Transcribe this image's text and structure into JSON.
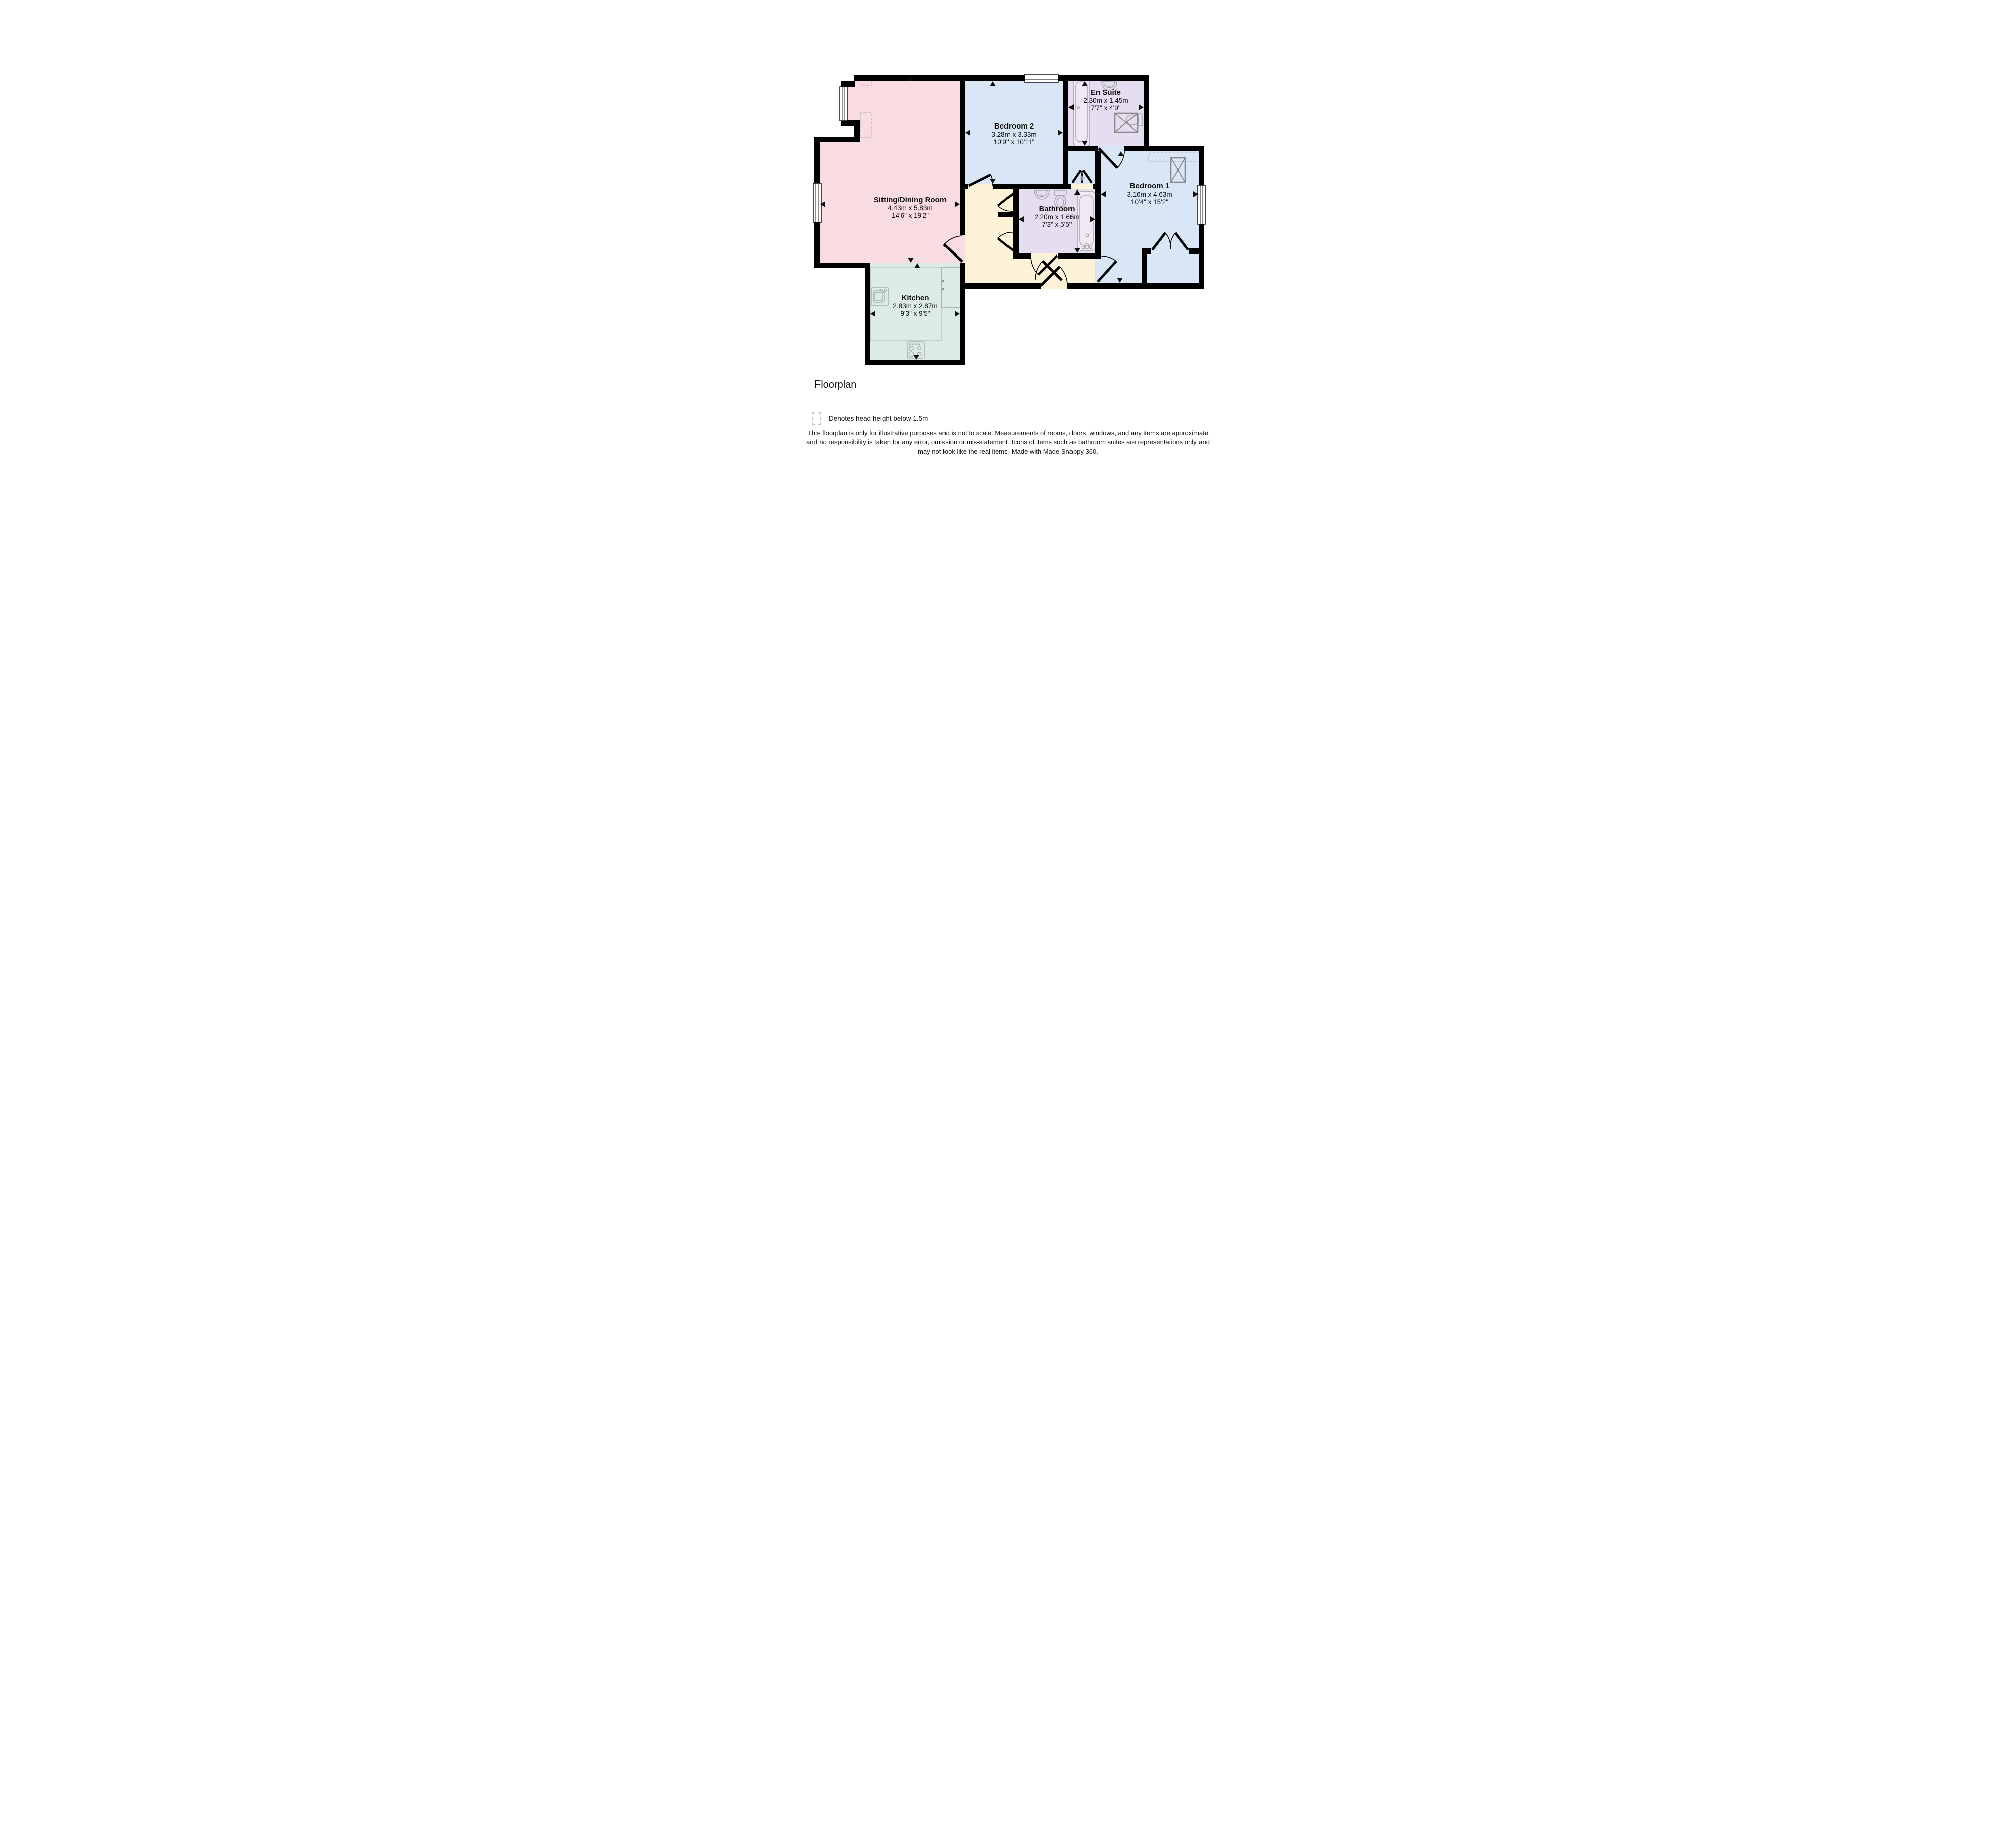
{
  "title": "Floorplan",
  "legend": {
    "icon": "dashed-rect-icon",
    "text": "Denotes head height below 1.5m"
  },
  "disclaimer": {
    "line1": "This floorplan is only for illustrative purposes and is not to scale. Measurements of rooms, doors, windows, and any items are approximate",
    "line2": "and no responsibility is taken for any error, omission or mis-statement. Icons of items such as bathroom suites are representations only and",
    "line3": "may not look like the real items. Made with Made Snappy 360."
  },
  "colors": {
    "wall": "#000000",
    "sitting_room": "#f9dce2",
    "bedroom": "#d9e6f5",
    "bathroom": "#e5def0",
    "hall": "#fcf2d8",
    "kitchen": "#dcebe4",
    "fixture_outline": "#9b9b9b",
    "shower_outline": "#8a8a8a",
    "dashed_head_height": "#c4c4c4"
  },
  "rooms": [
    {
      "id": "sitting-dining-room",
      "name": "Sitting/Dining Room",
      "dims_m": "4.43m x 5.83m",
      "dims_ft": "14'6\" x 19'2\""
    },
    {
      "id": "bedroom-2",
      "name": "Bedroom 2",
      "dims_m": "3.28m x 3.33m",
      "dims_ft": "10'9\" x 10'11\""
    },
    {
      "id": "en-suite",
      "name": "En Suite",
      "dims_m": "2.30m x 1.45m",
      "dims_ft": "7'7\" x 4'9\""
    },
    {
      "id": "bedroom-1",
      "name": "Bedroom 1",
      "dims_m": "3.16m x 4.63m",
      "dims_ft": "10'4\" x 15'2\""
    },
    {
      "id": "bathroom",
      "name": "Bathroom",
      "dims_m": "2.20m x 1.66m",
      "dims_ft": "7'3\" x 5'5\""
    },
    {
      "id": "kitchen",
      "name": "Kitchen",
      "dims_m": "2.83m x 2.87m",
      "dims_ft": "9'3\" x 9'5\""
    }
  ],
  "icons": [
    "window-icon",
    "door-icon",
    "bath-icon",
    "sink-icon",
    "toilet-icon",
    "shower-icon",
    "wardrobe-icon",
    "kitchen-sink-icon",
    "hob-icon",
    "counter-icon",
    "cabinet-icon",
    "dimension-arrow-icon"
  ]
}
